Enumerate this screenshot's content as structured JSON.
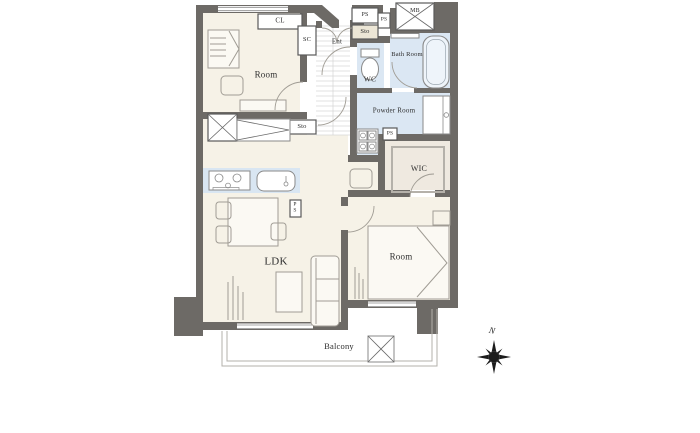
{
  "floorplan": {
    "labels": {
      "bedroom1": "Room",
      "closet": "CL",
      "shoe_cupboard": "SC",
      "entrance": "Ent",
      "pipe_space_top_1": "PS",
      "pipe_space_top_2": "PS",
      "storage_top": "Sto",
      "meter_box": "MB",
      "toilet_room": "WC",
      "bathroom": "Bath Room",
      "powder_room": "Powder Room",
      "pipe_space_mid": "PS",
      "walk_in_closet": "WIC",
      "storage_mid": "Sto",
      "pipe_space_kitchen": "PS",
      "living_dining_kitchen": "LDK",
      "bedroom2": "Room",
      "balcony": "Balcony",
      "compass_north": "N"
    },
    "colors": {
      "wall": "#6d6a66",
      "room_floor": "#f6f2e7",
      "wet_floor": "#dbe7f3",
      "wic_floor": "#efe9e0",
      "kitchen_counter": "#d9e6f2"
    }
  }
}
